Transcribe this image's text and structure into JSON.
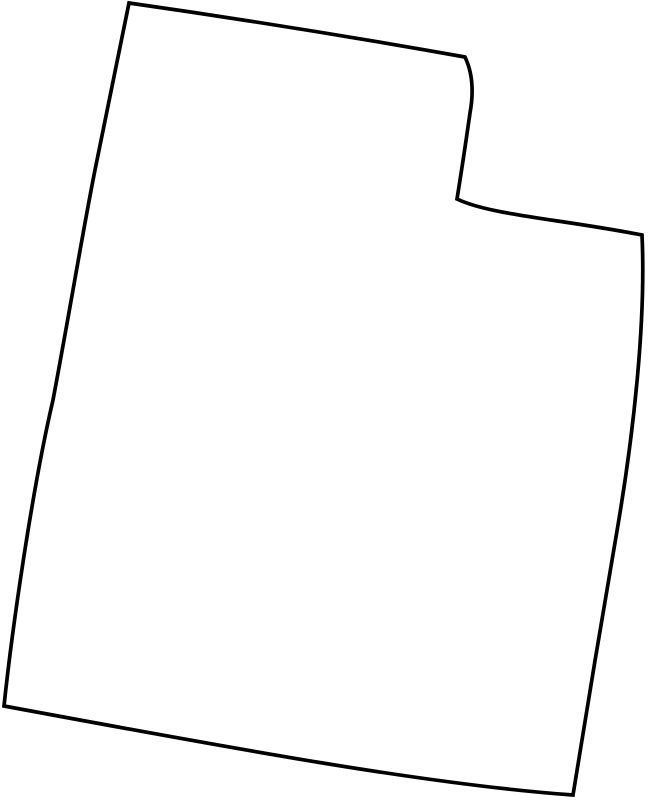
{
  "map": {
    "region_name": "Utah state outline",
    "path_d": "M 129,3 Q 297,27 465,57 Q 476,80 470,113 Q 463,162 457,199 C 490,215 560,219 642,235 C 646,320 634,430 618,525 C 602,620 588,700 573,795 C 430,785 230,748 4,706 C 12,630 32,490 53,400 C 70,310 83,230 95,170 L 129,3 Z",
    "stroke_color": "#000000",
    "fill_color": "#ffffff",
    "background_color": "#ffffff",
    "stroke_width": "3.7"
  }
}
